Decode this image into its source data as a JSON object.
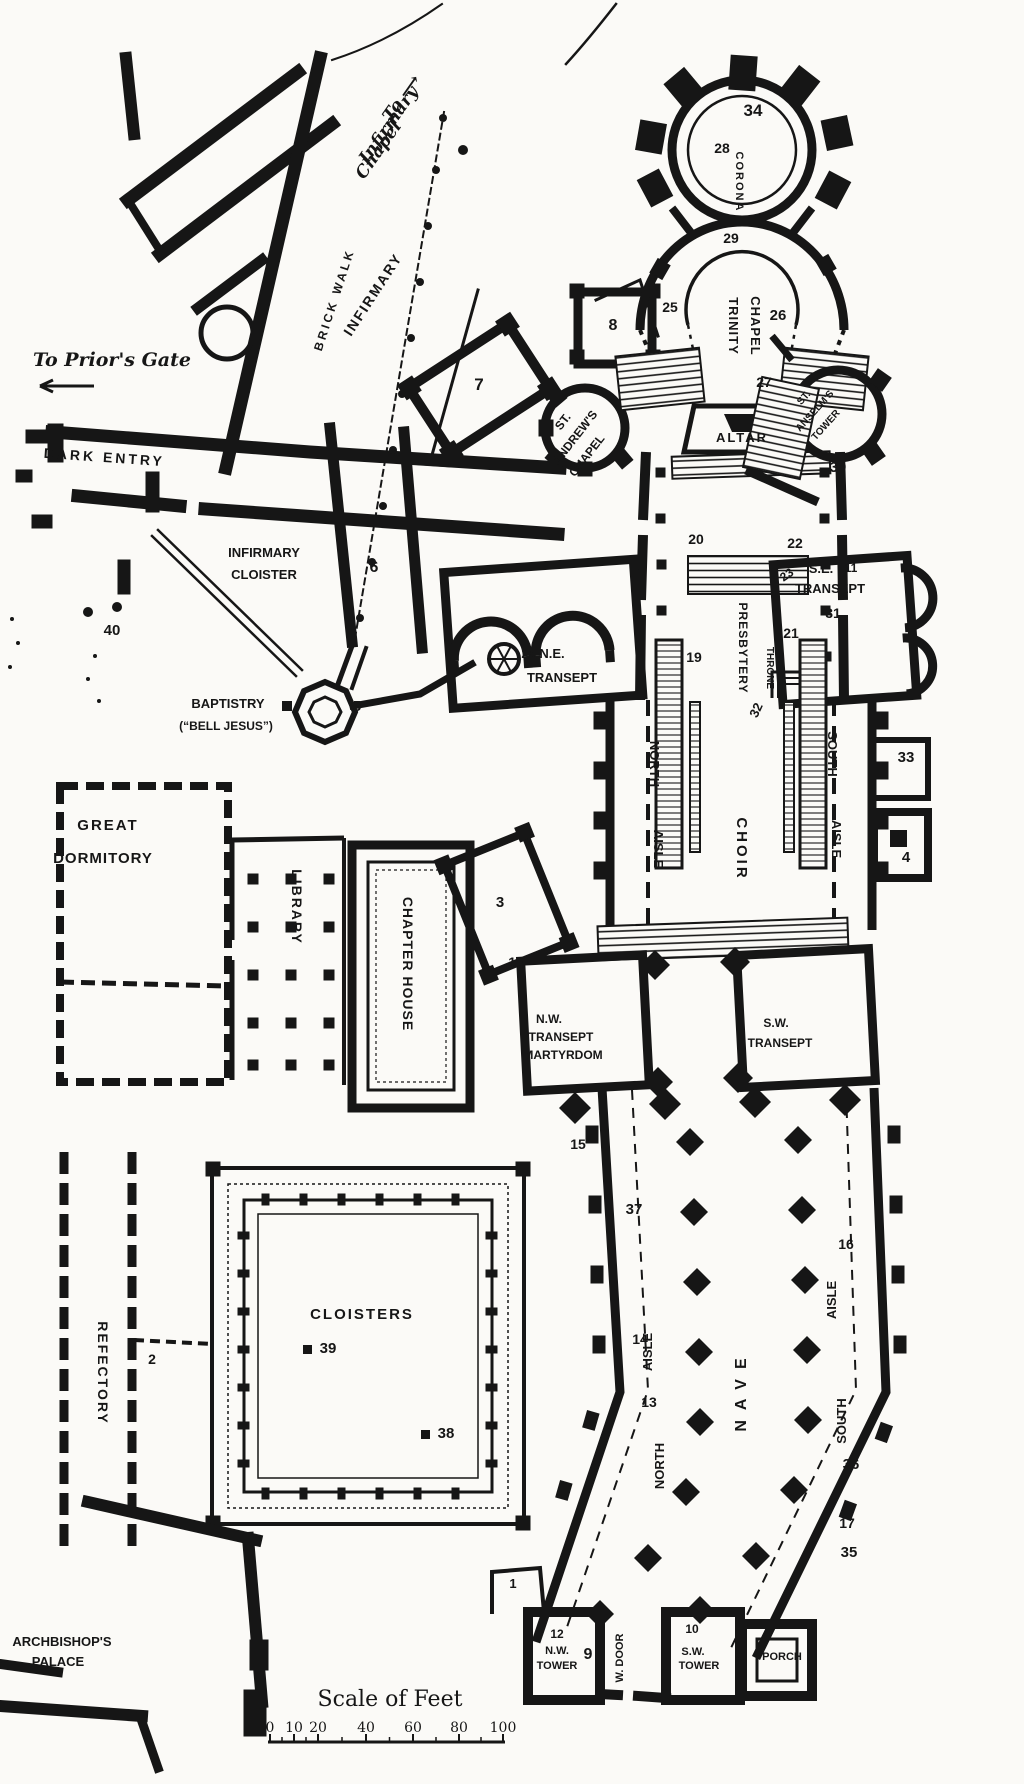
{
  "colors": {
    "ink": "#161616",
    "paper": "#fbfaf7"
  },
  "directions": [
    {
      "id": "to-infirmary-chapel-1",
      "text": "To ⟶",
      "x": 406,
      "y": 101,
      "rot": -55,
      "fs": 17,
      "style": "serifit"
    },
    {
      "id": "to-infirmary-chapel-2",
      "text": "Infirmary",
      "x": 393,
      "y": 128,
      "rot": -55,
      "fs": 17,
      "style": "serifit"
    },
    {
      "id": "to-infirmary-chapel-3",
      "text": "Chapel",
      "x": 383,
      "y": 153,
      "rot": -55,
      "fs": 17,
      "style": "serifit"
    },
    {
      "id": "to-priors-gate",
      "text": "To Prior's Gate",
      "x": 112,
      "y": 366,
      "rot": 0,
      "fs": 19,
      "style": "serifit"
    }
  ],
  "labels": [
    {
      "id": "n-34",
      "text": "34",
      "x": 753,
      "y": 116,
      "fs": 17
    },
    {
      "id": "n-28",
      "text": "28",
      "x": 722,
      "y": 153,
      "fs": 14
    },
    {
      "id": "corona",
      "text": "CORONA",
      "x": 736,
      "y": 182,
      "rot": 90,
      "fs": 11,
      "ls": 2
    },
    {
      "id": "n-29",
      "text": "29",
      "x": 731,
      "y": 243,
      "fs": 14
    },
    {
      "id": "n-25",
      "text": "25",
      "x": 670,
      "y": 312,
      "fs": 14
    },
    {
      "id": "trinity",
      "text": "TRINITY",
      "x": 729,
      "y": 326,
      "rot": 90,
      "fs": 13,
      "ls": 1
    },
    {
      "id": "chapel-trinity",
      "text": "CHAPEL",
      "x": 751,
      "y": 326,
      "rot": 90,
      "fs": 13,
      "ls": 1
    },
    {
      "id": "n-26",
      "text": "26",
      "x": 778,
      "y": 320,
      "fs": 15
    },
    {
      "id": "n-8",
      "text": "8",
      "x": 613,
      "y": 330,
      "fs": 16
    },
    {
      "id": "n-7",
      "text": "7",
      "x": 479,
      "y": 390,
      "fs": 17
    },
    {
      "id": "st-andrews-1",
      "text": "ST.",
      "x": 566,
      "y": 424,
      "rot": -52,
      "fs": 12
    },
    {
      "id": "st-andrews-2",
      "text": "ANDREW'S",
      "x": 578,
      "y": 440,
      "rot": -52,
      "fs": 12
    },
    {
      "id": "st-andrews-3",
      "text": "CHAPEL",
      "x": 590,
      "y": 458,
      "rot": -52,
      "fs": 12
    },
    {
      "id": "n-27",
      "text": "27",
      "x": 764,
      "y": 387,
      "fs": 14
    },
    {
      "id": "altar",
      "text": "ALTAR",
      "x": 742,
      "y": 442,
      "fs": 13,
      "ls": 2
    },
    {
      "id": "st-anselms-1",
      "text": "ST.",
      "x": 806,
      "y": 400,
      "rot": -48,
      "fs": 10
    },
    {
      "id": "st-anselms-2",
      "text": "ANSELM'S",
      "x": 817,
      "y": 413,
      "rot": -48,
      "fs": 10
    },
    {
      "id": "st-anselms-3",
      "text": "TOWER",
      "x": 828,
      "y": 427,
      "rot": -48,
      "fs": 10
    },
    {
      "id": "n-30",
      "text": "30",
      "x": 838,
      "y": 472,
      "fs": 15
    },
    {
      "id": "ne-transept-1",
      "text": "24 N.E.",
      "x": 543,
      "y": 658,
      "fs": 13
    },
    {
      "id": "ne-transept-2",
      "text": "TRANSEPT",
      "x": 562,
      "y": 682,
      "fs": 13
    },
    {
      "id": "n-20",
      "text": "20",
      "x": 696,
      "y": 544,
      "fs": 14
    },
    {
      "id": "n-22",
      "text": "22",
      "x": 795,
      "y": 548,
      "fs": 14
    },
    {
      "id": "n-23",
      "text": "23",
      "x": 789,
      "y": 578,
      "rot": -35,
      "fs": 12
    },
    {
      "id": "n-19",
      "text": "19",
      "x": 694,
      "y": 662,
      "fs": 14
    },
    {
      "id": "n-21",
      "text": "21",
      "x": 791,
      "y": 638,
      "fs": 14
    },
    {
      "id": "presbytery",
      "text": "PRESBYTERY",
      "x": 739,
      "y": 648,
      "rot": 90,
      "fs": 12,
      "ls": 1
    },
    {
      "id": "throne",
      "text": "THRONE",
      "x": 767,
      "y": 668,
      "rot": 90,
      "fs": 10
    },
    {
      "id": "se-transept-1",
      "text": "S.E.",
      "x": 821,
      "y": 573,
      "fs": 13
    },
    {
      "id": "n-11",
      "text": "11",
      "x": 851,
      "y": 572,
      "fs": 12
    },
    {
      "id": "se-transept-2",
      "text": "TRANSEPT",
      "x": 830,
      "y": 593,
      "fs": 13
    },
    {
      "id": "n-31",
      "text": "31",
      "x": 833,
      "y": 618,
      "fs": 14
    },
    {
      "id": "n-32",
      "text": "32",
      "x": 760,
      "y": 712,
      "rot": -65,
      "fs": 13
    },
    {
      "id": "north-choir",
      "text": "NORTH",
      "x": 650,
      "y": 764,
      "rot": 90,
      "fs": 13
    },
    {
      "id": "aisle-nchoir",
      "text": "AISLE",
      "x": 654,
      "y": 849,
      "rot": 90,
      "fs": 13
    },
    {
      "id": "choir",
      "text": "CHOIR",
      "x": 737,
      "y": 849,
      "rot": 90,
      "fs": 15,
      "ls": 3
    },
    {
      "id": "south-choir",
      "text": "SOUTH",
      "x": 828,
      "y": 754,
      "rot": 90,
      "fs": 13
    },
    {
      "id": "aisle-schoir",
      "text": "AISLE",
      "x": 832,
      "y": 839,
      "rot": 90,
      "fs": 13
    },
    {
      "id": "n-33",
      "text": "33",
      "x": 906,
      "y": 762,
      "fs": 15
    },
    {
      "id": "n-4",
      "text": "4",
      "x": 906,
      "y": 862,
      "fs": 15
    },
    {
      "id": "brick-walk",
      "text": "BRICK  WALK",
      "x": 338,
      "y": 301,
      "rot": -72,
      "fs": 12,
      "ls": 3
    },
    {
      "id": "infirmary",
      "text": "INFIRMARY",
      "x": 377,
      "y": 297,
      "rot": -57,
      "fs": 14,
      "ls": 2
    },
    {
      "id": "dark-entry",
      "text": "DARK  ENTRY",
      "x": 104,
      "y": 462,
      "rot": 4,
      "fs": 14,
      "ls": 3
    },
    {
      "id": "infirmary-cloister-1",
      "text": "INFIRMARY",
      "x": 264,
      "y": 557,
      "fs": 13
    },
    {
      "id": "infirmary-cloister-2",
      "text": "CLOISTER",
      "x": 264,
      "y": 579,
      "fs": 13
    },
    {
      "id": "n-40",
      "text": "40",
      "x": 112,
      "y": 635,
      "fs": 15
    },
    {
      "id": "n-6",
      "text": "6",
      "x": 374,
      "y": 572,
      "fs": 16
    },
    {
      "id": "baptistry-1",
      "text": "BAPTISTRY",
      "x": 228,
      "y": 708,
      "fs": 13
    },
    {
      "id": "baptistry-2",
      "text": "(“BELL JESUS”)",
      "x": 226,
      "y": 730,
      "fs": 12
    },
    {
      "id": "n-5",
      "text": "5",
      "x": 357,
      "y": 711,
      "fs": 15
    },
    {
      "id": "great-dormitory-1",
      "text": "GREAT",
      "x": 108,
      "y": 830,
      "fs": 15,
      "ls": 2
    },
    {
      "id": "great-dormitory-2",
      "text": "DORMITORY",
      "x": 103,
      "y": 863,
      "fs": 15,
      "ls": 1
    },
    {
      "id": "library",
      "text": "LIBRARY",
      "x": 292,
      "y": 907,
      "rot": 90,
      "fs": 14,
      "ls": 2
    },
    {
      "id": "chapter-house",
      "text": "CHAPTER HOUSE",
      "x": 403,
      "y": 964,
      "rot": 90,
      "fs": 14,
      "ls": 1
    },
    {
      "id": "n-3",
      "text": "3",
      "x": 500,
      "y": 907,
      "fs": 15
    },
    {
      "id": "n-18",
      "text": "18",
      "x": 516,
      "y": 967,
      "fs": 14
    },
    {
      "id": "nw-transept-1",
      "text": "N.W.",
      "x": 549,
      "y": 1023,
      "fs": 12
    },
    {
      "id": "nw-transept-2",
      "text": "TRANSEPT",
      "x": 561,
      "y": 1041,
      "fs": 12
    },
    {
      "id": "nw-transept-3",
      "text": "MARTYRDOM",
      "x": 563,
      "y": 1059,
      "fs": 12
    },
    {
      "id": "sw-transept-1",
      "text": "S.W.",
      "x": 776,
      "y": 1027,
      "fs": 12
    },
    {
      "id": "sw-transept-2",
      "text": "TRANSEPT",
      "x": 780,
      "y": 1047,
      "fs": 12
    },
    {
      "id": "n-15",
      "text": "15",
      "x": 578,
      "y": 1149,
      "fs": 14
    },
    {
      "id": "n-37",
      "text": "37",
      "x": 634,
      "y": 1214,
      "fs": 15
    },
    {
      "id": "n-14",
      "text": "14",
      "x": 640,
      "y": 1344,
      "fs": 14
    },
    {
      "id": "n-13",
      "text": "13",
      "x": 649,
      "y": 1407,
      "fs": 14
    },
    {
      "id": "aisle-nnave",
      "text": "AISLE",
      "x": 652,
      "y": 1352,
      "rot": -90,
      "fs": 13
    },
    {
      "id": "north-nave",
      "text": "NORTH",
      "x": 664,
      "y": 1466,
      "rot": -90,
      "fs": 13
    },
    {
      "id": "nave",
      "text": "NAVE",
      "x": 746,
      "y": 1390,
      "rot": -90,
      "fs": 16,
      "ls": 10
    },
    {
      "id": "aisle-snave",
      "text": "AISLE",
      "x": 836,
      "y": 1300,
      "rot": -90,
      "fs": 13
    },
    {
      "id": "south-nave",
      "text": "SOUTH",
      "x": 846,
      "y": 1421,
      "rot": -90,
      "fs": 13
    },
    {
      "id": "n-16",
      "text": "16",
      "x": 846,
      "y": 1249,
      "fs": 14
    },
    {
      "id": "n-36",
      "text": "36",
      "x": 851,
      "y": 1469,
      "fs": 15
    },
    {
      "id": "n-17",
      "text": "17",
      "x": 847,
      "y": 1528,
      "fs": 14
    },
    {
      "id": "n-35",
      "text": "35",
      "x": 849,
      "y": 1557,
      "fs": 15
    },
    {
      "id": "cloisters",
      "text": "CLOISTERS",
      "x": 362,
      "y": 1319,
      "fs": 15,
      "ls": 2
    },
    {
      "id": "n-39",
      "text": "39",
      "x": 328,
      "y": 1353,
      "fs": 15
    },
    {
      "id": "n-38",
      "text": "38",
      "x": 446,
      "y": 1438,
      "fs": 15
    },
    {
      "id": "n-2",
      "text": "2",
      "x": 152,
      "y": 1364,
      "fs": 14
    },
    {
      "id": "refectory",
      "text": "REFECTORY",
      "x": 98,
      "y": 1373,
      "rot": 90,
      "fs": 14,
      "ls": 2
    },
    {
      "id": "palace-1",
      "text": "ARCHBISHOP'S",
      "x": 62,
      "y": 1646,
      "fs": 13
    },
    {
      "id": "palace-2",
      "text": "PALACE",
      "x": 58,
      "y": 1666,
      "fs": 13
    },
    {
      "id": "n-1",
      "text": "1",
      "x": 513,
      "y": 1588,
      "fs": 13
    },
    {
      "id": "n-12",
      "text": "12",
      "x": 557,
      "y": 1638,
      "fs": 12
    },
    {
      "id": "nw-tower-1",
      "text": "N.W.",
      "x": 557,
      "y": 1654,
      "fs": 11
    },
    {
      "id": "nw-tower-2",
      "text": "TOWER",
      "x": 557,
      "y": 1669,
      "fs": 11
    },
    {
      "id": "n-9",
      "text": "9",
      "x": 588,
      "y": 1659,
      "fs": 16
    },
    {
      "id": "w-door",
      "text": "W. DOOR",
      "x": 623,
      "y": 1658,
      "rot": -90,
      "fs": 11
    },
    {
      "id": "n-10",
      "text": "10",
      "x": 692,
      "y": 1633,
      "fs": 12
    },
    {
      "id": "sw-tower-1",
      "text": "S.W.",
      "x": 693,
      "y": 1655,
      "fs": 11
    },
    {
      "id": "sw-tower-2",
      "text": "TOWER",
      "x": 699,
      "y": 1669,
      "fs": 11
    },
    {
      "id": "n-8b",
      "text": "8.",
      "x": 741,
      "y": 1661,
      "fs": 12
    },
    {
      "id": "porch",
      "text": "PORCH",
      "x": 782,
      "y": 1660,
      "fs": 11
    }
  ],
  "scale_bar": {
    "title": "Scale of Feet",
    "title_x": 390,
    "title_y": 1706,
    "bar_y": 1742,
    "bar_x1": 268,
    "bar_x2": 505,
    "ticks": [
      {
        "label": "0",
        "x": 270
      },
      {
        "label": "10",
        "x": 294
      },
      {
        "label": "20",
        "x": 318
      },
      {
        "label": "40",
        "x": 366
      },
      {
        "label": "60",
        "x": 413
      },
      {
        "label": "80",
        "x": 459
      },
      {
        "label": "100",
        "x": 503
      }
    ]
  },
  "markers": {
    "dots": [
      {
        "x": 88,
        "y": 612,
        "r": 5
      },
      {
        "x": 117,
        "y": 607,
        "r": 5
      },
      {
        "x": 95,
        "y": 656,
        "r": 2
      },
      {
        "x": 88,
        "y": 679,
        "r": 2
      },
      {
        "x": 99,
        "y": 701,
        "r": 2
      },
      {
        "x": 12,
        "y": 619,
        "r": 2
      },
      {
        "x": 18,
        "y": 643,
        "r": 2
      },
      {
        "x": 10,
        "y": 667,
        "r": 2
      },
      {
        "x": 360,
        "y": 618,
        "r": 4
      },
      {
        "x": 372,
        "y": 562,
        "r": 4
      },
      {
        "x": 383,
        "y": 506,
        "r": 4
      },
      {
        "x": 393,
        "y": 450,
        "r": 4
      },
      {
        "x": 402,
        "y": 394,
        "r": 4
      },
      {
        "x": 411,
        "y": 338,
        "r": 4
      },
      {
        "x": 420,
        "y": 282,
        "r": 4
      },
      {
        "x": 428,
        "y": 226,
        "r": 4
      },
      {
        "x": 436,
        "y": 170,
        "r": 4
      },
      {
        "x": 443,
        "y": 118,
        "r": 4
      },
      {
        "x": 463,
        "y": 150,
        "r": 5
      }
    ],
    "squares": [
      {
        "x": 303,
        "y": 1345,
        "s": 9
      },
      {
        "x": 421,
        "y": 1430,
        "s": 9
      },
      {
        "x": 377,
        "y": 568,
        "s": 0
      },
      {
        "x": 282,
        "y": 701,
        "s": 10
      }
    ]
  }
}
